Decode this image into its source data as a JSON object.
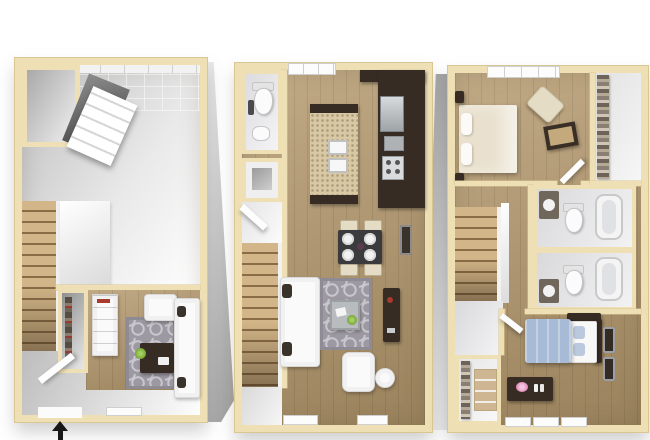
{
  "meta": {
    "type": "3D floor plan rendering",
    "description": "Three-level townhome floor plan, three bird's-eye 3D plans side by side",
    "visible_text": "",
    "levels_shown": 3
  },
  "palette": {
    "background": "#ffffff",
    "wall_cap": "#eee0b4",
    "wall_cap_edge": "#d8c794",
    "wall_white": "#f4f4f4",
    "wall_shadow": "#a8a8a8",
    "wood_floor": "#b3976b",
    "stair_wood": "#c8aa7a",
    "garage_floor": "#d9d9d9",
    "bath_floor": "#e6e6e8",
    "rug_gray": "#9d99a2",
    "rug_pattern": "#c9c7cd",
    "espresso": "#362c23",
    "granite": "#d8c8a4",
    "stainless": "#c6cacd",
    "white_furniture": "#fafafa",
    "bed_beige": "#e9e1ce",
    "bed_blue": "#a7bbd6",
    "pillow_blue": "#bac9de",
    "chair_beige": "#e5dcc6",
    "plant_green": "#7fae3e",
    "accent_red": "#a83a2e",
    "flower_pink": "#e08ab8",
    "arrow_black": "#161616"
  },
  "levels": [
    {
      "id": "level-1",
      "position": "left",
      "rooms": [
        {
          "name": "garage",
          "features": [
            "open-garage-door-panel",
            "ceiling-grid",
            "storage-closet"
          ]
        },
        {
          "name": "staircase"
        },
        {
          "name": "den",
          "features": [
            "closet",
            "bookcase",
            "trellis-rug",
            "ottoman",
            "plant",
            "armchair",
            "sofa"
          ]
        },
        {
          "name": "entry",
          "features": [
            "front-door-open",
            "window-sill"
          ]
        }
      ]
    },
    {
      "id": "level-2",
      "position": "middle",
      "rooms": [
        {
          "name": "half-bathroom",
          "features": [
            "toilet",
            "pedestal-sink"
          ]
        },
        {
          "name": "closet",
          "features": [
            "utility-box"
          ]
        },
        {
          "name": "kitchen",
          "features": [
            "granite-island-double-sink",
            "refrigerator",
            "microwave",
            "range",
            "espresso-counters",
            "window"
          ]
        },
        {
          "name": "dining-area",
          "features": [
            "table-with-four-plates",
            "four-chairs"
          ]
        },
        {
          "name": "living-room",
          "features": [
            "sofa",
            "trellis-rug",
            "coffee-table",
            "armchair",
            "round-side-table",
            "tv-console",
            "wall-art",
            "two-window-sills"
          ]
        },
        {
          "name": "staircase"
        }
      ]
    },
    {
      "id": "level-3",
      "position": "right",
      "rooms": [
        {
          "name": "primary-bedroom",
          "features": [
            "bed",
            "two-nightstands",
            "accent-chair",
            "framed-art",
            "window"
          ]
        },
        {
          "name": "walk-in-closet",
          "features": [
            "clothes-shelves"
          ]
        },
        {
          "name": "bathroom-1",
          "features": [
            "tub",
            "toilet",
            "vanity"
          ]
        },
        {
          "name": "bathroom-2",
          "features": [
            "tub",
            "toilet",
            "vanity"
          ]
        },
        {
          "name": "bedroom-2",
          "features": [
            "blue-bed",
            "dresser-with-flowers",
            "two-wall-frames",
            "three-window-sills"
          ]
        },
        {
          "name": "closet",
          "features": [
            "clothes-shelves"
          ]
        },
        {
          "name": "staircase"
        }
      ]
    }
  ],
  "entry_marker": {
    "shape": "arrow",
    "direction": "up",
    "meaning": "entrance",
    "color": "#161616"
  }
}
